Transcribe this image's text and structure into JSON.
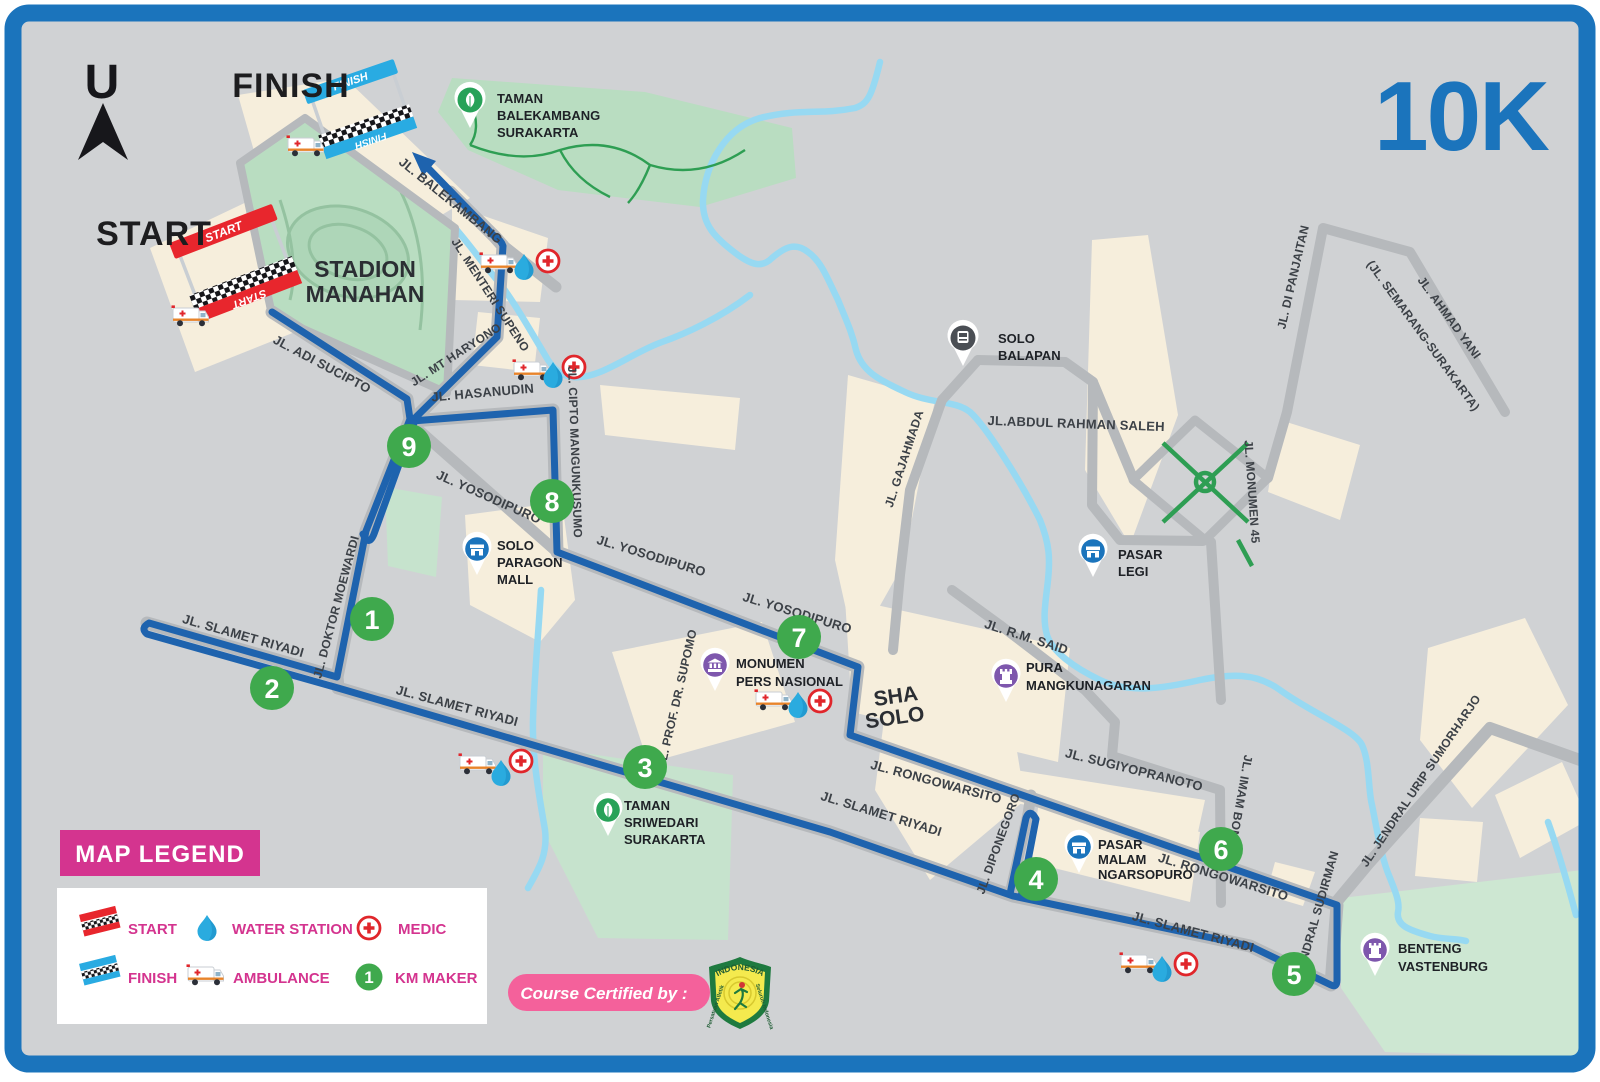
{
  "header": {
    "compass": "U",
    "distance": "10K"
  },
  "banners": {
    "start": "START",
    "finish": "FINISH"
  },
  "map_titles": {
    "start_big": "START",
    "finish_big": "FINISH",
    "stadium_l1": "STADION",
    "stadium_l2": "MANAHAN",
    "sha_l1": "SHA",
    "sha_l2": "SOLO"
  },
  "roads": {
    "adi_sucipto": "JL. ADI SUCIPTO",
    "mt_haryono": "JL. MT HARYONO",
    "menteri_supeno": "JL. MENTERI SUPENO",
    "balekambang": "JL. BALEKAMBANG",
    "hasanudin": "JL. HASANUDIN",
    "cipto": "JL. CIPTO MANGUNKUSUMO",
    "yosodipuro": "JL. YOSODIPURO",
    "moewardi": "JL. DOKTOR MOEWARDI",
    "slamet": "JL. SLAMET RIYADI",
    "supomo": "JL. PROF. DR. SUPOMO",
    "rongowarsito": "JL. RONGOWARSITO",
    "diponegoro": "JL. DIPONEGORO",
    "sugiyopranoto": "JL. SUGIYOPRANOTO",
    "imam_bonjol": "JL. IMAM BONJOL",
    "sudirman": "JL. JENDRAL SUDIRMAN",
    "urip": "JL. JENDRAL URIP SUMORHARJO",
    "gajahmada": "JL. GAJAHMADA",
    "abdul": "JL.ABDUL RAHMAN SALEH",
    "rm_said": "JL. R.M. SAID",
    "monumen45": "JL. MONUMEN 45",
    "panjaitan": "JL. DI PANJAITAN",
    "ahmad_yani_1": "JL. AHMAD YANI",
    "ahmad_yani_2": "(JL. SEMARANG-SURAKARTA)"
  },
  "pois": {
    "balekambang": {
      "l1": "TAMAN",
      "l2": "BALEKAMBANG",
      "l3": "SURAKARTA"
    },
    "balapan": {
      "l1": "SOLO",
      "l2": "BALAPAN"
    },
    "pasar_legi": {
      "l1": "PASAR",
      "l2": "LEGI"
    },
    "pura": {
      "l1": "PURA",
      "l2": "MANGKUNAGARAN"
    },
    "paragon": {
      "l1": "SOLO",
      "l2": "PARAGON",
      "l3": "MALL"
    },
    "monumen_pers": {
      "l1": "MONUMEN",
      "l2": "PERS NASIONAL"
    },
    "sriwedari": {
      "l1": "TAMAN",
      "l2": "SRIWEDARI",
      "l3": "SURAKARTA"
    },
    "pasar_malam": {
      "l1": "PASAR",
      "l2": "MALAM",
      "l3": "NGARSOPURO"
    },
    "benteng": {
      "l1": "BENTENG",
      "l2": "VASTENBURG"
    }
  },
  "km_markers": [
    "1",
    "2",
    "3",
    "4",
    "5",
    "6",
    "7",
    "8",
    "9"
  ],
  "legend": {
    "title": "MAP LEGEND",
    "start": "START",
    "water": "WATER STATION",
    "medic": "MEDIC",
    "finish": "FINISH",
    "ambulance": "AMBULANCE",
    "km": "KM MAKER",
    "km_icon": "1"
  },
  "certified": {
    "label": "Course Certified by :",
    "badge_title": "INDONESIA",
    "badge_left": "Persatuan Atletik",
    "badge_right": "Seluruh Indonesia"
  },
  "colors": {
    "frame_blue": "#1b74bc",
    "route_blue": "#1e63ae",
    "km_green": "#3fa94d",
    "legend_pink": "#d4348f",
    "pill_pink": "#f4619b",
    "river_blue": "#97d9f2",
    "medic_red": "#e0262b"
  }
}
